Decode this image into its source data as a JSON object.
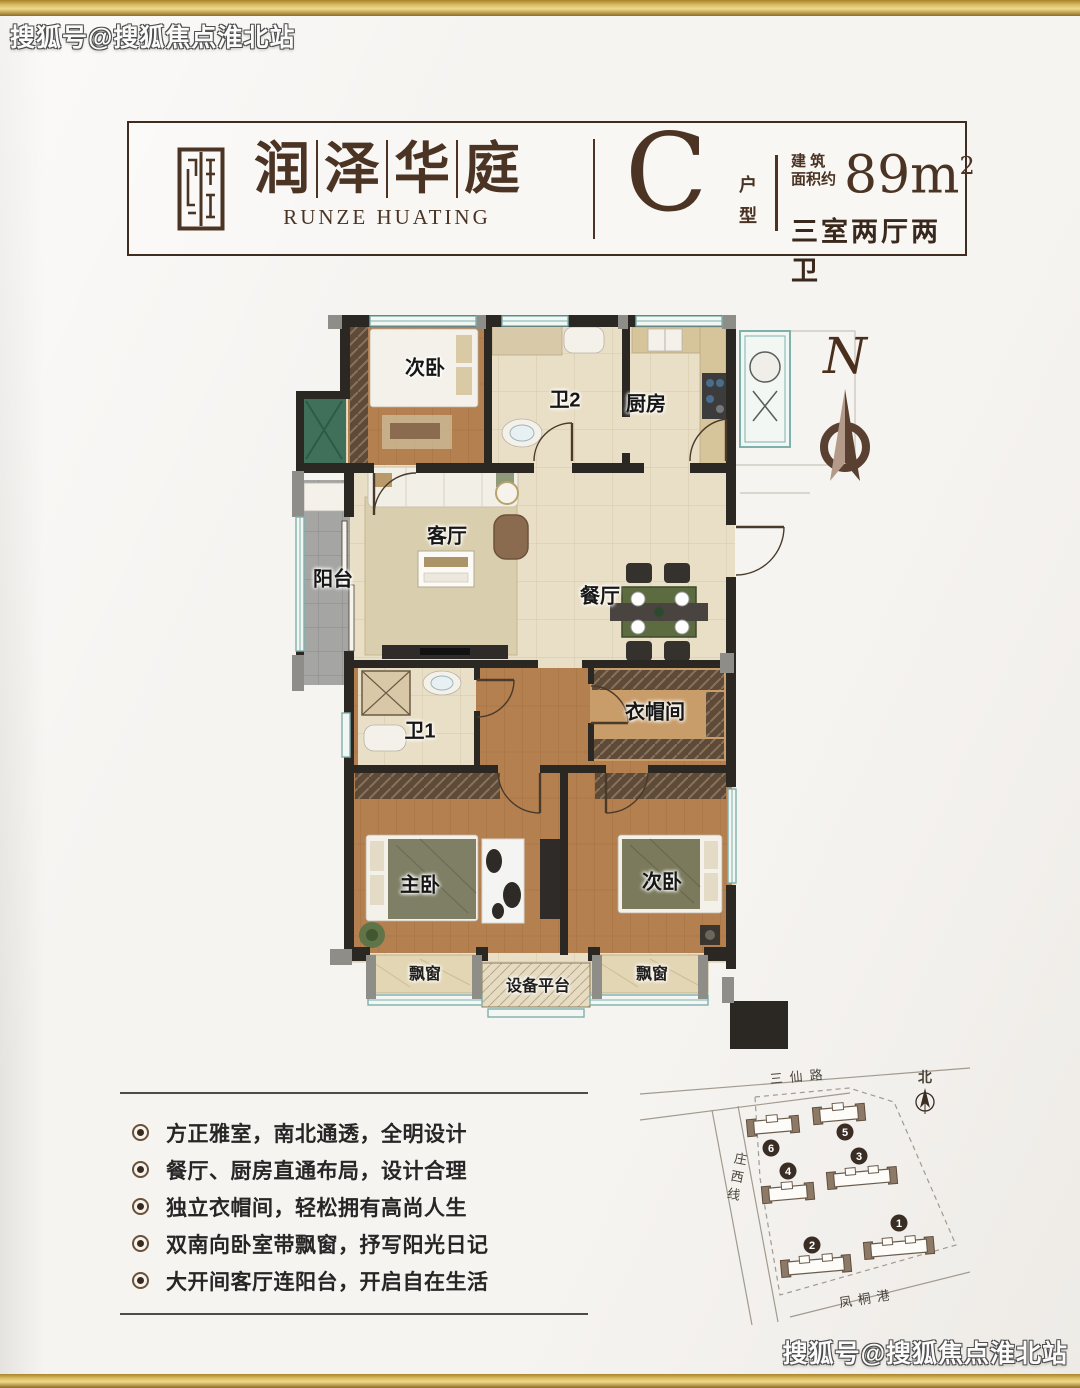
{
  "watermark": {
    "top": "搜狐号@搜狐焦点淮北站",
    "bottom": "搜狐号@搜狐焦点淮北站"
  },
  "header": {
    "title_chars": [
      "润",
      "泽",
      "华",
      "庭"
    ],
    "subtitle_en": "RUNZE HUATING",
    "unit_letter": "C",
    "unit_type_chars": [
      "户",
      "型"
    ],
    "area_label_line1": "建 筑",
    "area_label_line2": "面积约",
    "area_value": "89m",
    "area_exponent": "2",
    "layout_summary": "三室两厅两卫"
  },
  "floorplan": {
    "compass_letter": "N",
    "rooms": [
      {
        "label": "次卧"
      },
      {
        "label": "卫2"
      },
      {
        "label": "厨房"
      },
      {
        "label": "阳台"
      },
      {
        "label": "客厅"
      },
      {
        "label": "餐厅"
      },
      {
        "label": "卫1"
      },
      {
        "label": "衣帽间"
      },
      {
        "label": "主卧"
      },
      {
        "label": "次卧"
      }
    ],
    "annotations": [
      {
        "label": "飘窗"
      },
      {
        "label": "设备平台"
      },
      {
        "label": "飘窗"
      }
    ]
  },
  "features": {
    "items": [
      "方正雅室，南北通透，全明设计",
      "餐厅、厨房直通布局，设计合理",
      "独立衣帽间，轻松拥有高尚人生",
      "双南向卧室带飘窗，抒写阳光日记",
      "大开间客厅连阳台，开启自在生活"
    ]
  },
  "siteplan": {
    "road_top": "三仙路",
    "road_left": "庄西线",
    "road_bottom": "凤桐港",
    "north_label": "北",
    "building_numbers": [
      "1",
      "2",
      "3",
      "4",
      "5",
      "6"
    ]
  },
  "colors": {
    "gold": "#d9bc62",
    "brand_brown": "#4b3423",
    "wall_dark": "#2b2723",
    "floor_beige": "#e9dfc6",
    "floor_wood": "#b5804f",
    "window_teal": "#7fb0ac"
  }
}
